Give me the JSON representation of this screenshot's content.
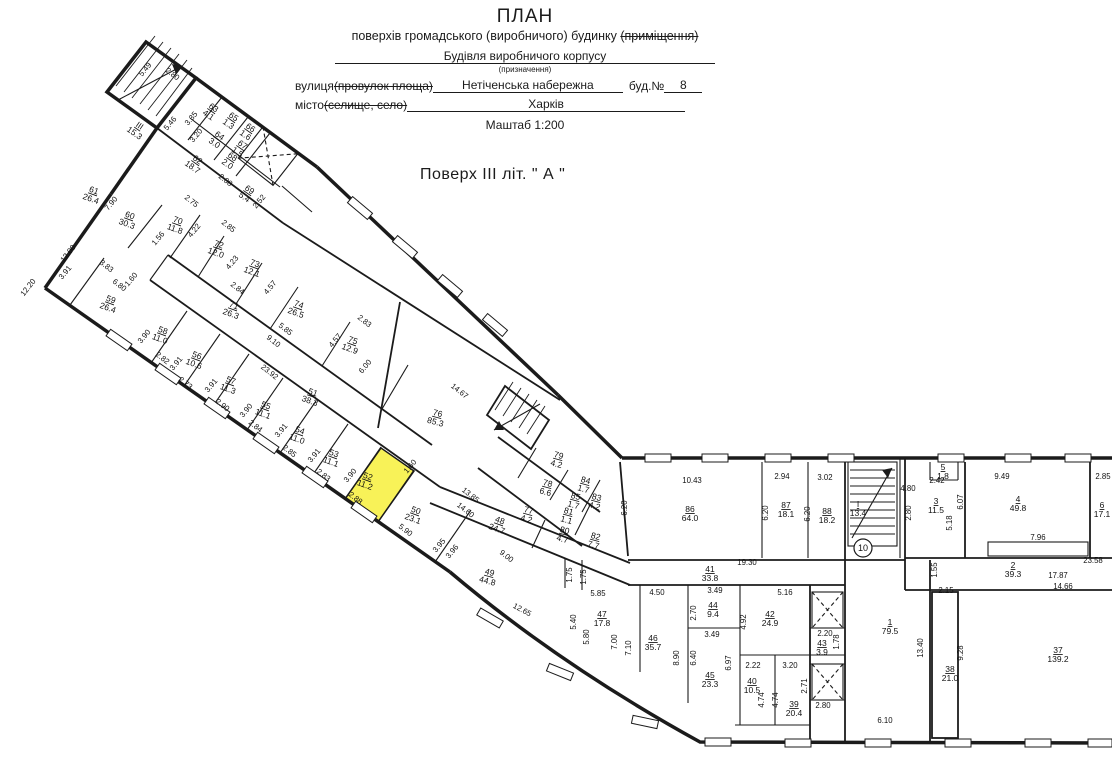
{
  "header": {
    "title": "ПЛАН",
    "subtitle_plain": "поверхів громадського (виробничого) будинку ",
    "subtitle_struck": "(приміщення)",
    "purpose_value": "Будівля виробничого корпусу",
    "purpose_caption": "(призначення)",
    "street_label": "вулиця ",
    "street_struck": "(провулок площа)",
    "street_value": "Нетіченська набережна",
    "building_label": "буд.№",
    "building_value": "8",
    "city_label": "місто ",
    "city_struck": "(селище, село)",
    "city_value": "Харків",
    "scale": "Маштаб 1:200",
    "floor_title": "Поверх ІІІ літ. \" А \""
  },
  "plan": {
    "highlight_color": "#f8f258",
    "ink_color": "#1b1b1b",
    "badges": [
      {
        "t": "10",
        "x": 863,
        "y": 548
      }
    ],
    "rooms": [
      {
        "num": "ІІІ",
        "area": "15.3",
        "x": 138,
        "y": 128,
        "rot": 35
      },
      {
        "num": "63",
        "area": "4.1",
        "x": 212,
        "y": 110,
        "rot": 35
      },
      {
        "num": "65",
        "area": "1.3",
        "x": 232,
        "y": 119,
        "rot": 35
      },
      {
        "num": "66",
        "area": "1.6",
        "x": 249,
        "y": 130,
        "rot": 35
      },
      {
        "num": "64",
        "area": "3.0",
        "x": 218,
        "y": 138,
        "rot": 35
      },
      {
        "num": "67",
        "area": "1.5",
        "x": 241,
        "y": 147,
        "rot": 35
      },
      {
        "num": "68",
        "area": "2.0",
        "x": 231,
        "y": 159,
        "rot": 35
      },
      {
        "num": "62",
        "area": "18.7",
        "x": 196,
        "y": 162,
        "rot": 35
      },
      {
        "num": "69",
        "area": "5.4",
        "x": 248,
        "y": 192,
        "rot": 35
      },
      {
        "num": "61",
        "area": "26.4",
        "x": 93,
        "y": 193,
        "rot": 20
      },
      {
        "num": "60",
        "area": "30.3",
        "x": 129,
        "y": 218,
        "rot": 20
      },
      {
        "num": "70",
        "area": "11.8",
        "x": 177,
        "y": 223,
        "rot": 20
      },
      {
        "num": "72",
        "area": "12.0",
        "x": 218,
        "y": 247,
        "rot": 20
      },
      {
        "num": "73",
        "area": "12.1",
        "x": 254,
        "y": 266,
        "rot": 20
      },
      {
        "num": "74",
        "area": "26.5",
        "x": 298,
        "y": 307,
        "rot": 20
      },
      {
        "num": "75",
        "area": "12.9",
        "x": 352,
        "y": 343,
        "rot": 20
      },
      {
        "num": "71",
        "area": "26.3",
        "x": 233,
        "y": 308,
        "rot": 20
      },
      {
        "num": "51",
        "area": "38.3",
        "x": 312,
        "y": 395,
        "rot": 20
      },
      {
        "num": "76",
        "area": "85.3",
        "x": 437,
        "y": 416,
        "rot": 15
      },
      {
        "num": "59",
        "area": "26.4",
        "x": 110,
        "y": 302,
        "rot": 20
      },
      {
        "num": "58",
        "area": "11.0",
        "x": 162,
        "y": 333,
        "rot": 20
      },
      {
        "num": "56",
        "area": "10.6",
        "x": 196,
        "y": 358,
        "rot": 20
      },
      {
        "num": "57",
        "area": "11.3",
        "x": 230,
        "y": 383,
        "rot": 20
      },
      {
        "num": "55",
        "area": "11.1",
        "x": 265,
        "y": 408,
        "rot": 20
      },
      {
        "num": "54",
        "area": "11.0",
        "x": 299,
        "y": 433,
        "rot": 20
      },
      {
        "num": "53",
        "area": "11.1",
        "x": 333,
        "y": 456,
        "rot": 20
      },
      {
        "num": "52",
        "area": "11.2",
        "x": 367,
        "y": 479,
        "rot": 20,
        "highlight": true
      },
      {
        "num": "50",
        "area": "23.1",
        "x": 415,
        "y": 513,
        "rot": 20
      },
      {
        "num": "48",
        "area": "24.7",
        "x": 499,
        "y": 523,
        "rot": 20
      },
      {
        "num": "49",
        "area": "44.8",
        "x": 489,
        "y": 575,
        "rot": 15
      },
      {
        "num": "79",
        "area": "4.2",
        "x": 558,
        "y": 458,
        "rot": 15
      },
      {
        "num": "78",
        "area": "6.6",
        "x": 547,
        "y": 486,
        "rot": 15
      },
      {
        "num": "77",
        "area": "4.2",
        "x": 528,
        "y": 513,
        "rot": 15
      },
      {
        "num": "84",
        "area": "1.7",
        "x": 585,
        "y": 483,
        "rot": 15
      },
      {
        "num": "85",
        "area": "1.7",
        "x": 575,
        "y": 499,
        "rot": 15
      },
      {
        "num": "83",
        "area": "4.2",
        "x": 596,
        "y": 500,
        "rot": 15
      },
      {
        "num": "81",
        "area": "1.1",
        "x": 568,
        "y": 514,
        "rot": 15
      },
      {
        "num": "80",
        "area": "4.7",
        "x": 564,
        "y": 533,
        "rot": 15
      },
      {
        "num": "82",
        "area": "7.7",
        "x": 595,
        "y": 539,
        "rot": 15
      },
      {
        "num": "86",
        "area": "64.0",
        "x": 690,
        "y": 512,
        "rot": 0
      },
      {
        "num": "87",
        "area": "18.1",
        "x": 786,
        "y": 508,
        "rot": 0
      },
      {
        "num": "88",
        "area": "18.2",
        "x": 827,
        "y": 514,
        "rot": 0
      },
      {
        "num": "І",
        "area": "13.4",
        "x": 858,
        "y": 507,
        "rot": 0
      },
      {
        "num": "41",
        "area": "33.8",
        "x": 710,
        "y": 572,
        "rot": 0
      },
      {
        "num": "5",
        "area": "1.8",
        "x": 943,
        "y": 470,
        "rot": 0
      },
      {
        "num": "3",
        "area": "11.5",
        "x": 936,
        "y": 504,
        "rot": 0
      },
      {
        "num": "4",
        "area": "49.8",
        "x": 1018,
        "y": 502,
        "rot": 0
      },
      {
        "num": "6",
        "area": "17.1",
        "x": 1102,
        "y": 508,
        "rot": 0
      },
      {
        "num": "2",
        "area": "39.3",
        "x": 1013,
        "y": 568,
        "rot": 0
      },
      {
        "num": "47",
        "area": "17.8",
        "x": 602,
        "y": 617,
        "rot": 0
      },
      {
        "num": "46",
        "area": "35.7",
        "x": 653,
        "y": 641,
        "rot": 0
      },
      {
        "num": "44",
        "area": "9.4",
        "x": 713,
        "y": 608,
        "rot": 0
      },
      {
        "num": "45",
        "area": "23.3",
        "x": 710,
        "y": 678,
        "rot": 0
      },
      {
        "num": "42",
        "area": "24.9",
        "x": 770,
        "y": 617,
        "rot": 0
      },
      {
        "num": "43",
        "area": "3.9",
        "x": 822,
        "y": 646,
        "rot": 0
      },
      {
        "num": "40",
        "area": "10.5",
        "x": 752,
        "y": 684,
        "rot": 0
      },
      {
        "num": "39",
        "area": "20.4",
        "x": 794,
        "y": 707,
        "rot": 0
      },
      {
        "num": "1",
        "area": "79.5",
        "x": 890,
        "y": 625,
        "rot": 0
      },
      {
        "num": "38",
        "area": "21.0",
        "x": 950,
        "y": 672,
        "rot": 0
      },
      {
        "num": "37",
        "area": "139.2",
        "x": 1058,
        "y": 653,
        "rot": 0
      }
    ],
    "dims": [
      {
        "t": "5.49",
        "x": 147,
        "y": 71,
        "rot": -50
      },
      {
        "t": "2.80",
        "x": 171,
        "y": 76,
        "rot": 38
      },
      {
        "t": "5.46",
        "x": 172,
        "y": 125,
        "rot": -50
      },
      {
        "t": "3.35",
        "x": 193,
        "y": 120,
        "rot": -50
      },
      {
        "t": "3.20",
        "x": 198,
        "y": 137,
        "rot": -50
      },
      {
        "t": "2.08",
        "x": 224,
        "y": 182,
        "rot": 38
      },
      {
        "t": "2.52",
        "x": 261,
        "y": 203,
        "rot": -50
      },
      {
        "t": "12.00",
        "x": 70,
        "y": 255,
        "rot": -52
      },
      {
        "t": "12.20",
        "x": 30,
        "y": 289,
        "rot": -52
      },
      {
        "t": "3.91",
        "x": 67,
        "y": 274,
        "rot": -50
      },
      {
        "t": "3.83",
        "x": 105,
        "y": 268,
        "rot": 38
      },
      {
        "t": "6.80",
        "x": 118,
        "y": 287,
        "rot": 38
      },
      {
        "t": "1.60",
        "x": 133,
        "y": 281,
        "rot": -50
      },
      {
        "t": "1.56",
        "x": 160,
        "y": 240,
        "rot": -50
      },
      {
        "t": "7.90",
        "x": 113,
        "y": 205,
        "rot": -50
      },
      {
        "t": "2.75",
        "x": 190,
        "y": 203,
        "rot": 38
      },
      {
        "t": "4.22",
        "x": 196,
        "y": 232,
        "rot": -50
      },
      {
        "t": "2.85",
        "x": 227,
        "y": 228,
        "rot": 38
      },
      {
        "t": "4.23",
        "x": 234,
        "y": 264,
        "rot": -50
      },
      {
        "t": "2.84",
        "x": 236,
        "y": 290,
        "rot": 38
      },
      {
        "t": "4.57",
        "x": 272,
        "y": 289,
        "rot": -50
      },
      {
        "t": "23.92",
        "x": 268,
        "y": 374,
        "rot": 38
      },
      {
        "t": "9.10",
        "x": 272,
        "y": 343,
        "rot": 38
      },
      {
        "t": "5.85",
        "x": 284,
        "y": 331,
        "rot": 38
      },
      {
        "t": "14.67",
        "x": 458,
        "y": 393,
        "rot": 38
      },
      {
        "t": "2.83",
        "x": 363,
        "y": 323,
        "rot": 38
      },
      {
        "t": "4.57",
        "x": 337,
        "y": 342,
        "rot": -50
      },
      {
        "t": "6.00",
        "x": 367,
        "y": 368,
        "rot": -50
      },
      {
        "t": "3.90",
        "x": 146,
        "y": 338,
        "rot": -50
      },
      {
        "t": "2.82",
        "x": 161,
        "y": 360,
        "rot": 38
      },
      {
        "t": "3.91",
        "x": 178,
        "y": 365,
        "rot": -50
      },
      {
        "t": "2.73",
        "x": 184,
        "y": 385,
        "rot": 38
      },
      {
        "t": "3.91",
        "x": 213,
        "y": 387,
        "rot": -50
      },
      {
        "t": "2.90",
        "x": 221,
        "y": 407,
        "rot": 38
      },
      {
        "t": "3.90",
        "x": 248,
        "y": 412,
        "rot": -50
      },
      {
        "t": "2.84",
        "x": 254,
        "y": 428,
        "rot": 38
      },
      {
        "t": "3.91",
        "x": 283,
        "y": 432,
        "rot": -50
      },
      {
        "t": "2.85",
        "x": 288,
        "y": 453,
        "rot": 38
      },
      {
        "t": "3.91",
        "x": 316,
        "y": 457,
        "rot": -50
      },
      {
        "t": "2.83",
        "x": 322,
        "y": 477,
        "rot": 38
      },
      {
        "t": "3.90",
        "x": 352,
        "y": 477,
        "rot": -50
      },
      {
        "t": "2.88",
        "x": 354,
        "y": 500,
        "rot": 38
      },
      {
        "t": "5.90",
        "x": 404,
        "y": 532,
        "rot": 38
      },
      {
        "t": "3.95",
        "x": 441,
        "y": 547,
        "rot": -50
      },
      {
        "t": "3.96",
        "x": 454,
        "y": 553,
        "rot": -50
      },
      {
        "t": "1.60",
        "x": 412,
        "y": 468,
        "rot": -50
      },
      {
        "t": "13.85",
        "x": 469,
        "y": 497,
        "rot": 38
      },
      {
        "t": "14.60",
        "x": 464,
        "y": 512,
        "rot": 38
      },
      {
        "t": "9.00",
        "x": 505,
        "y": 558,
        "rot": 38
      },
      {
        "t": "12.65",
        "x": 521,
        "y": 612,
        "rot": 28
      },
      {
        "t": "1.75",
        "x": 572,
        "y": 575,
        "rot": -90
      },
      {
        "t": "1.75",
        "x": 586,
        "y": 577,
        "rot": -90
      },
      {
        "t": "6.20",
        "x": 627,
        "y": 508,
        "rot": -90
      },
      {
        "t": "10.43",
        "x": 692,
        "y": 483,
        "rot": 0
      },
      {
        "t": "2.94",
        "x": 782,
        "y": 479,
        "rot": 0
      },
      {
        "t": "6.20",
        "x": 768,
        "y": 513,
        "rot": -90
      },
      {
        "t": "3.02",
        "x": 825,
        "y": 480,
        "rot": 0
      },
      {
        "t": "6.20",
        "x": 810,
        "y": 514,
        "rot": -90
      },
      {
        "t": "19.30",
        "x": 747,
        "y": 565,
        "rot": 0
      },
      {
        "t": "4.80",
        "x": 908,
        "y": 491,
        "rot": 0
      },
      {
        "t": "2.80",
        "x": 911,
        "y": 513,
        "rot": -90
      },
      {
        "t": "2.42",
        "x": 937,
        "y": 483,
        "rot": 0
      },
      {
        "t": "5.18",
        "x": 952,
        "y": 523,
        "rot": -90
      },
      {
        "t": "6.07",
        "x": 963,
        "y": 502,
        "rot": -90
      },
      {
        "t": "9.49",
        "x": 1002,
        "y": 479,
        "rot": 0
      },
      {
        "t": "7.96",
        "x": 1038,
        "y": 540,
        "rot": 0
      },
      {
        "t": "2.85",
        "x": 1103,
        "y": 479,
        "rot": 0
      },
      {
        "t": "23.58",
        "x": 1093,
        "y": 563,
        "rot": 0
      },
      {
        "t": "1.55",
        "x": 937,
        "y": 570,
        "rot": -90
      },
      {
        "t": "17.87",
        "x": 1058,
        "y": 578,
        "rot": 0
      },
      {
        "t": "14.66",
        "x": 1063,
        "y": 589,
        "rot": 0
      },
      {
        "t": "2.15",
        "x": 946,
        "y": 593,
        "rot": 0
      },
      {
        "t": "5.85",
        "x": 598,
        "y": 596,
        "rot": 0
      },
      {
        "t": "4.50",
        "x": 657,
        "y": 595,
        "rot": 0
      },
      {
        "t": "3.49",
        "x": 715,
        "y": 593,
        "rot": 0
      },
      {
        "t": "5.16",
        "x": 785,
        "y": 595,
        "rot": 0
      },
      {
        "t": "5.40",
        "x": 576,
        "y": 622,
        "rot": -90
      },
      {
        "t": "5.80",
        "x": 589,
        "y": 637,
        "rot": -90
      },
      {
        "t": "7.00",
        "x": 617,
        "y": 642,
        "rot": -90
      },
      {
        "t": "7.10",
        "x": 631,
        "y": 648,
        "rot": -90
      },
      {
        "t": "2.70",
        "x": 696,
        "y": 613,
        "rot": -90
      },
      {
        "t": "3.49",
        "x": 712,
        "y": 637,
        "rot": 0
      },
      {
        "t": "8.90",
        "x": 679,
        "y": 658,
        "rot": -90
      },
      {
        "t": "6.40",
        "x": 696,
        "y": 658,
        "rot": -90
      },
      {
        "t": "6.97",
        "x": 731,
        "y": 663,
        "rot": -90
      },
      {
        "t": "4.92",
        "x": 746,
        "y": 622,
        "rot": -90
      },
      {
        "t": "2.20",
        "x": 825,
        "y": 636,
        "rot": 0
      },
      {
        "t": "1.78",
        "x": 839,
        "y": 642,
        "rot": -90
      },
      {
        "t": "2.22",
        "x": 753,
        "y": 668,
        "rot": 0
      },
      {
        "t": "3.20",
        "x": 790,
        "y": 668,
        "rot": 0
      },
      {
        "t": "4.74",
        "x": 764,
        "y": 700,
        "rot": -90
      },
      {
        "t": "4.74",
        "x": 778,
        "y": 700,
        "rot": -90
      },
      {
        "t": "2.71",
        "x": 807,
        "y": 686,
        "rot": -90
      },
      {
        "t": "2.80",
        "x": 823,
        "y": 708,
        "rot": 0
      },
      {
        "t": "13.40",
        "x": 923,
        "y": 648,
        "rot": -90
      },
      {
        "t": "9.28",
        "x": 963,
        "y": 653,
        "rot": -90
      },
      {
        "t": "6.10",
        "x": 885,
        "y": 723,
        "rot": 0
      }
    ]
  }
}
